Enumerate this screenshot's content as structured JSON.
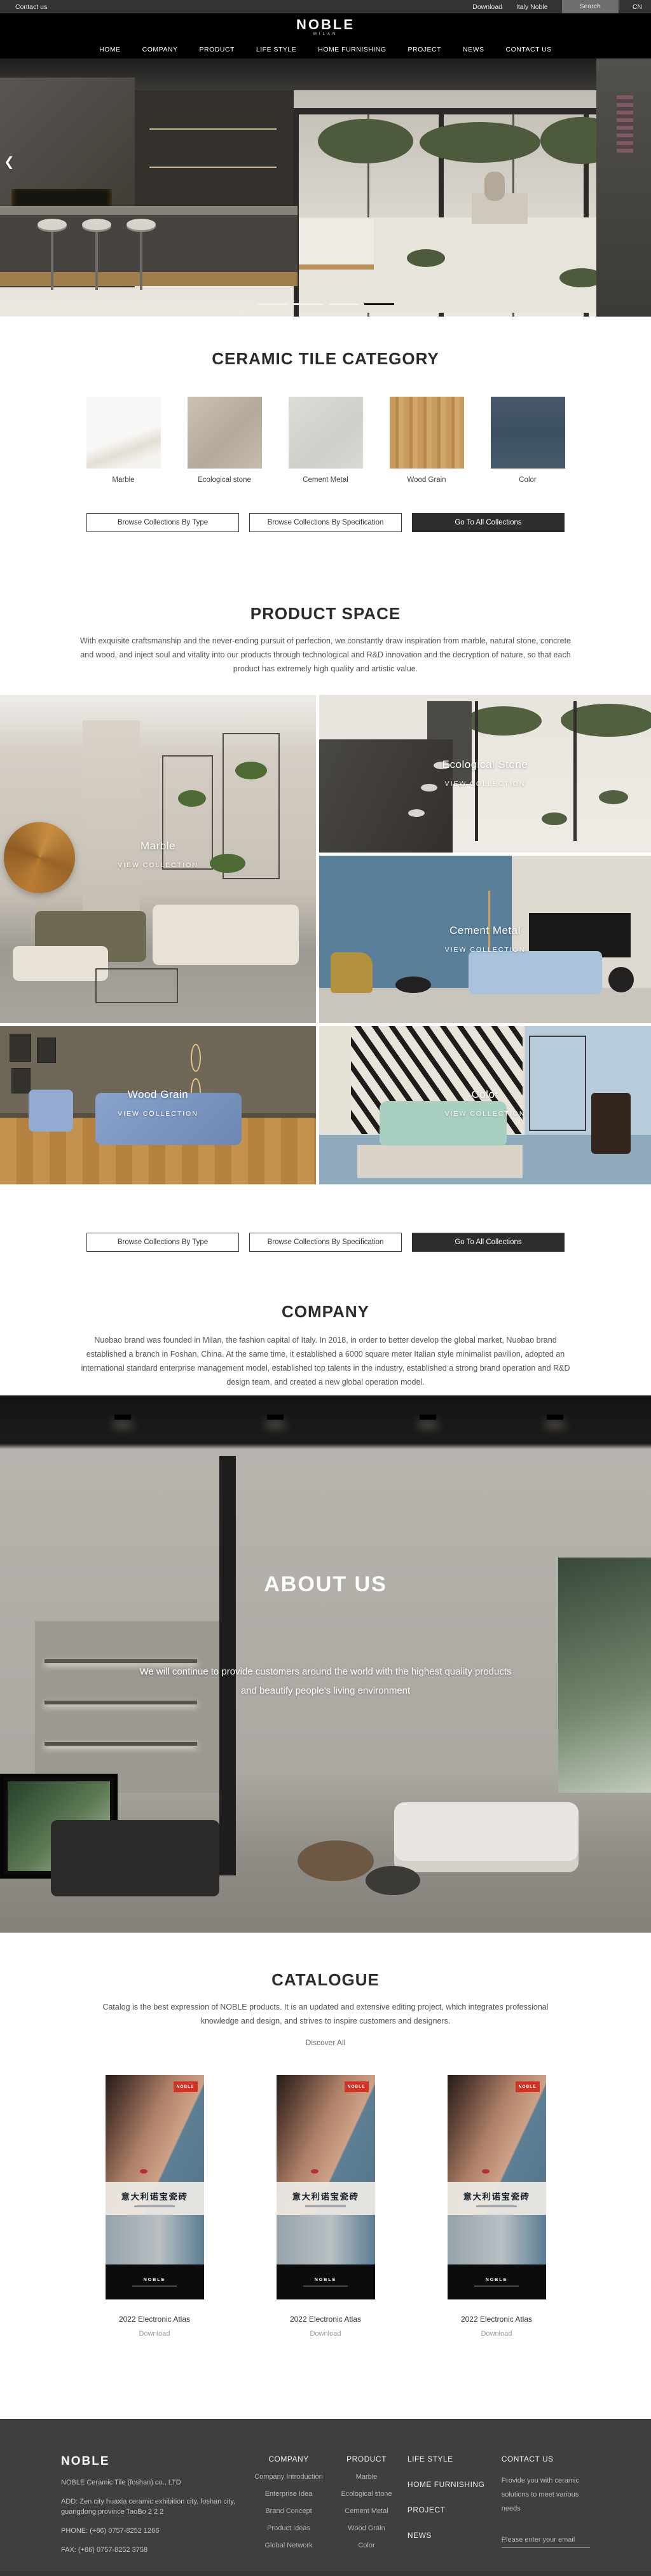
{
  "topbar": {
    "contact": "Contact us",
    "download": "Download",
    "italy": "Italy Noble",
    "search": "Search",
    "lang": "CN"
  },
  "header": {
    "logo": "NOBLE",
    "sub": "MILAN"
  },
  "nav": {
    "items": [
      {
        "label": "HOME"
      },
      {
        "label": "COMPANY"
      },
      {
        "label": "PRODUCT"
      },
      {
        "label": "LIFE STYLE"
      },
      {
        "label": "HOME FURNISHING"
      },
      {
        "label": "PROJECT"
      },
      {
        "label": "NEWS"
      },
      {
        "label": "CONTACT US"
      }
    ]
  },
  "hero": {
    "prev_icon": "❮",
    "slides_total": 4,
    "active_slide": 4
  },
  "category": {
    "title": "CERAMIC TILE CATEGORY",
    "tiles": [
      {
        "label": "Marble",
        "color": "#f6f4f1"
      },
      {
        "label": "Ecological stone",
        "color": "#bfb5a6"
      },
      {
        "label": "Cement Metal",
        "color": "#d6d4ce"
      },
      {
        "label": "Wood Grain",
        "color": "#c3924f"
      },
      {
        "label": "Color",
        "color": "#425568"
      }
    ]
  },
  "collection_buttons": {
    "by_type": "Browse Collections By Type",
    "by_spec": "Browse Collections By Specification",
    "all": "Go To All Collections"
  },
  "product_space": {
    "title": "PRODUCT SPACE",
    "description": "With exquisite craftsmanship and the never-ending pursuit of perfection, we constantly draw inspiration from marble, natural stone, concrete and wood, and inject soul and vitality into our products through technological and R&D innovation and the decryption of nature, so that each product has extremely high quality and artistic value.",
    "tiles": [
      {
        "name": "Marble",
        "cta": "VIEW COLLECTION"
      },
      {
        "name": "Ecological Stone",
        "cta": "VIEW COLLECTION"
      },
      {
        "name": "Cement Metal",
        "cta": "VIEW COLLECTION"
      },
      {
        "name": "Wood Grain",
        "cta": "VIEW COLLECTION"
      },
      {
        "name": "Color",
        "cta": "VIEW COLLECTION"
      }
    ]
  },
  "company": {
    "title": "COMPANY",
    "description": "Nuobao brand was founded in Milan, the fashion capital of Italy. In 2018, in order to better develop the global market, Nuobao brand established a branch in Foshan, China. At the same time, it established a 6000 square meter Italian style minimalist pavilion, adopted an international standard enterprise management model, established top talents in the industry, established a strong brand operation and R&D design team, and created a new global operation model."
  },
  "about": {
    "title": "ABOUT US",
    "line1": "We will continue to provide customers around the world with the highest quality products",
    "line2": "and beautify people's living environment"
  },
  "catalogue": {
    "title": "CATALOGUE",
    "description": "Catalog is the best expression of NOBLE products. It is an updated and extensive editing project, which integrates professional knowledge and design, and strives to inspire customers and designers.",
    "discover": "Discover All",
    "items": [
      {
        "cover_logo": "NOBLE",
        "cover_title": "意大利诺宝瓷砖",
        "title": "2022 Electronic Atlas",
        "download": "Download"
      },
      {
        "cover_logo": "NOBLE",
        "cover_title": "意大利诺宝瓷砖",
        "title": "2022 Electronic Atlas",
        "download": "Download"
      },
      {
        "cover_logo": "NOBLE",
        "cover_title": "意大利诺宝瓷砖",
        "title": "2022 Electronic Atlas",
        "download": "Download"
      }
    ]
  },
  "footer": {
    "logo": "NOBLE",
    "company_name": "NOBLE Ceramic Tile (foshan) co., LTD",
    "address": "ADD:  Zen city huaxia ceramic exhibition city, foshan city, guangdong province TaoBo 2 2 2",
    "phone": "PHONE:   (+86)  0757-8252 1266",
    "fax": "FAX:   (+86)  0757-8252 3758",
    "columns": [
      {
        "title": "COMPANY",
        "links": [
          "Company Introduction",
          "Enterprise Idea",
          "Brand Concept",
          "Product Ideas",
          "Global Network"
        ]
      },
      {
        "title": "PRODUCT",
        "links": [
          "Marble",
          "Ecological stone",
          "Cement Metal",
          "Wood Grain",
          "Color"
        ]
      }
    ],
    "nav_links": [
      "LIFE STYLE",
      "HOME FURNISHING",
      "PROJECT",
      "NEWS"
    ],
    "contact": {
      "title": "CONTACT US",
      "text": "Provide you with ceramic solutions to meet various needs",
      "email_placeholder": "Please enter your email"
    },
    "accent_color": "#cf3426",
    "background_color": "#3f3f3f"
  }
}
